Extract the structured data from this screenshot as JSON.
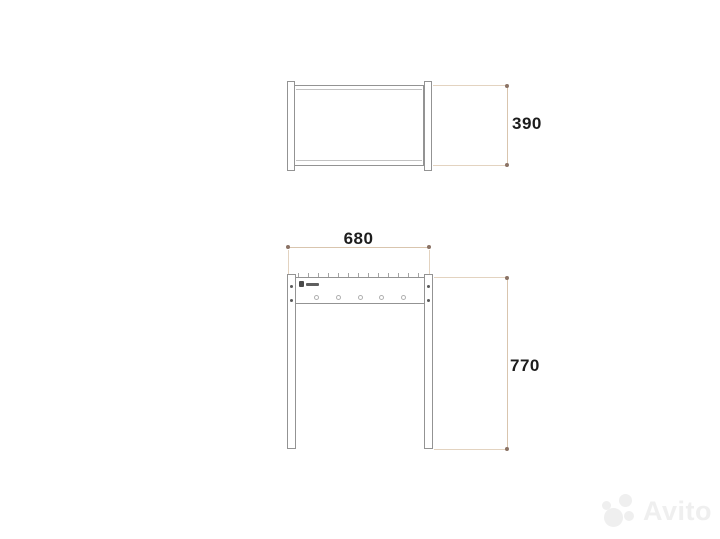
{
  "page": {
    "background": "#ffffff"
  },
  "drawing": {
    "colors": {
      "outline": "#939393",
      "outline_light": "#c2c2c2",
      "dimension_line": "#d9c5ae",
      "dimension_extension": "#e3d3c0",
      "dimension_marker": "#8b7365",
      "dimension_text": "#1d1d1d"
    },
    "dimensions": {
      "depth": {
        "value": "390"
      },
      "width": {
        "value": "680"
      },
      "height": {
        "value": "770"
      }
    },
    "front_view": {
      "skewer_hole_count": 5,
      "notch_count": 13,
      "leg_screw_count": 4,
      "brand_mark": "small-illegible-manufacturer-logo"
    }
  },
  "watermark": {
    "text": "Avito",
    "color": "#efefef",
    "logo": "avito-four-circles"
  }
}
